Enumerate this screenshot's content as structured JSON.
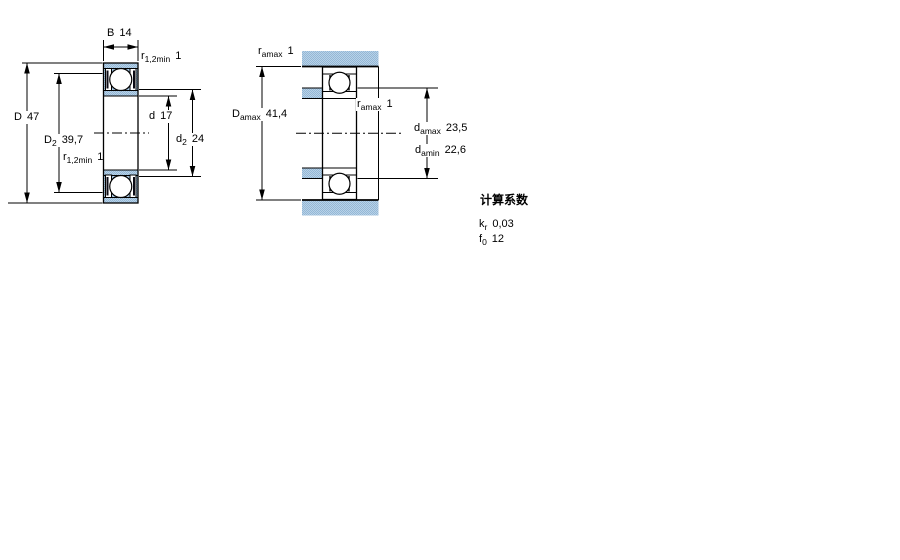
{
  "colors": {
    "section_fill_light": "#b9d2e6",
    "section_fill_dark": "#93b7d7",
    "line": "#000000",
    "background": "#ffffff"
  },
  "left_diagram": {
    "dims": {
      "B": {
        "sym": "B",
        "sub": "",
        "value": "14"
      },
      "r12_top": {
        "sym": "r",
        "sub": "1,2min",
        "value": "1"
      },
      "D": {
        "sym": "D",
        "sub": "",
        "value": "47"
      },
      "D2": {
        "sym": "D",
        "sub": "2",
        "value": "39,7"
      },
      "r12_bottom": {
        "sym": "r",
        "sub": "1,2min",
        "value": "1"
      },
      "d": {
        "sym": "d",
        "sub": "",
        "value": "17"
      },
      "d2": {
        "sym": "d",
        "sub": "2",
        "value": "24"
      }
    }
  },
  "right_diagram": {
    "dims": {
      "ra_top": {
        "sym": "r",
        "sub": "amax",
        "value": "1"
      },
      "Da_max": {
        "sym": "D",
        "sub": "amax",
        "value": "41,4"
      },
      "ra_mid": {
        "sym": "r",
        "sub": "amax",
        "value": "1"
      },
      "da_max": {
        "sym": "d",
        "sub": "amax",
        "value": "23,5"
      },
      "da_min": {
        "sym": "d",
        "sub": "amin",
        "value": "22,6"
      }
    }
  },
  "calculation_factors": {
    "title": "计算系数",
    "rows": [
      {
        "sym": "k",
        "sub": "r",
        "value": "0,03"
      },
      {
        "sym": "f",
        "sub": "0",
        "value": "12"
      }
    ]
  }
}
